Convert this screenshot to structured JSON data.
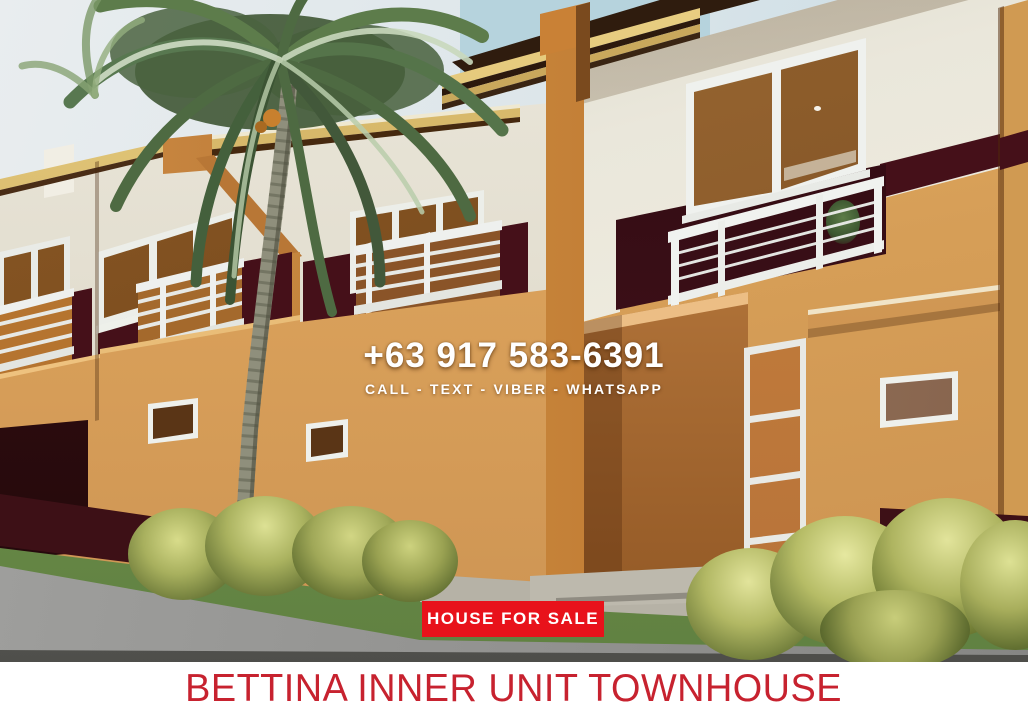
{
  "overlay": {
    "phone": "+63 917 583-6391",
    "contact_methods": "CALL - TEXT - VIBER - WHATSAPP",
    "sale_badge": "HOUSE FOR SALE",
    "banner_title": "BETTINA INNER UNIT TOWNHOUSE"
  },
  "colors": {
    "badge_red": "#e8121b",
    "banner_text_red": "#c7222f",
    "banner_bg": "#ffffff",
    "overlay_text_white": "#ffffff",
    "wall_cream": "#e9e5d8",
    "wall_orange": "#d9a25c",
    "accent_maroon": "#451019",
    "fascia_tan": "#d2b466",
    "foliage_green": "#5d7c4b",
    "bush_yellow_green": "#c9cf7a",
    "road_gray": "#949492"
  }
}
